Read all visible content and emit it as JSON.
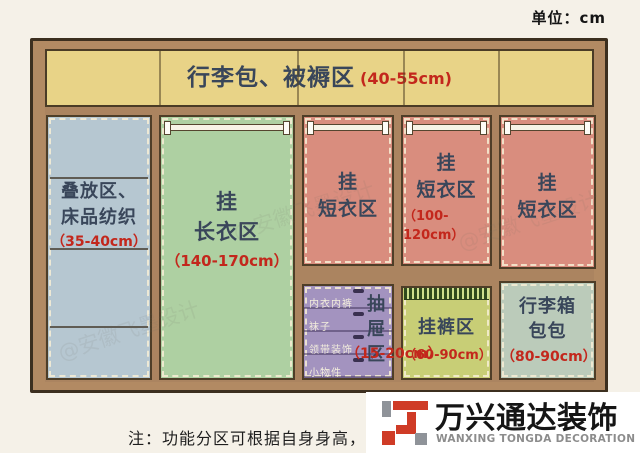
{
  "meta": {
    "unit_label": "单位：cm"
  },
  "zones": {
    "top": {
      "name": "行李包、被褥区",
      "size": "(40-55cm)"
    },
    "fold": {
      "name1": "叠放区、",
      "name2": "床品纺织",
      "size": "（35-40cm）"
    },
    "long": {
      "name1": "挂",
      "name2": "长衣区",
      "size": "（140-170cm）"
    },
    "short1": {
      "name1": "挂",
      "name2": "短衣区"
    },
    "short2": {
      "name1": "挂",
      "name2": "短衣区",
      "size": "（100-120cm）"
    },
    "short3": {
      "name1": "挂",
      "name2": "短衣区"
    },
    "drawers": {
      "name": "抽屉区",
      "size": "（15-20cm）",
      "items": [
        "内衣内裤",
        "袜子",
        "领带装饰",
        "小物件"
      ]
    },
    "pants": {
      "name": "挂裤区",
      "size": "（60-90cm）"
    },
    "luggage": {
      "name1": "行李箱",
      "name2": "包包",
      "size": "（80-90cm）"
    }
  },
  "note": "注：功能分区可根据自身身高，和",
  "logo": {
    "name_cn": "万兴通达装饰",
    "name_en": "WANXING TONGDA DECORATION"
  },
  "watermark": "@安徽飞墨设计",
  "colors": {
    "background": "#f5f1e8",
    "wood": "#b28a63",
    "top_shelf": "#e8d387",
    "fold_zone": "#b6c7d1",
    "long_zone": "#aed0a2",
    "short_zone": "#d98d7e",
    "drawer_zone": "#a393bf",
    "pants_zone": "#c8ce76",
    "luggage_zone": "#bbcbba",
    "title_text": "#39465a",
    "size_text": "#c3271c",
    "logo_red": "#cf3b26"
  }
}
